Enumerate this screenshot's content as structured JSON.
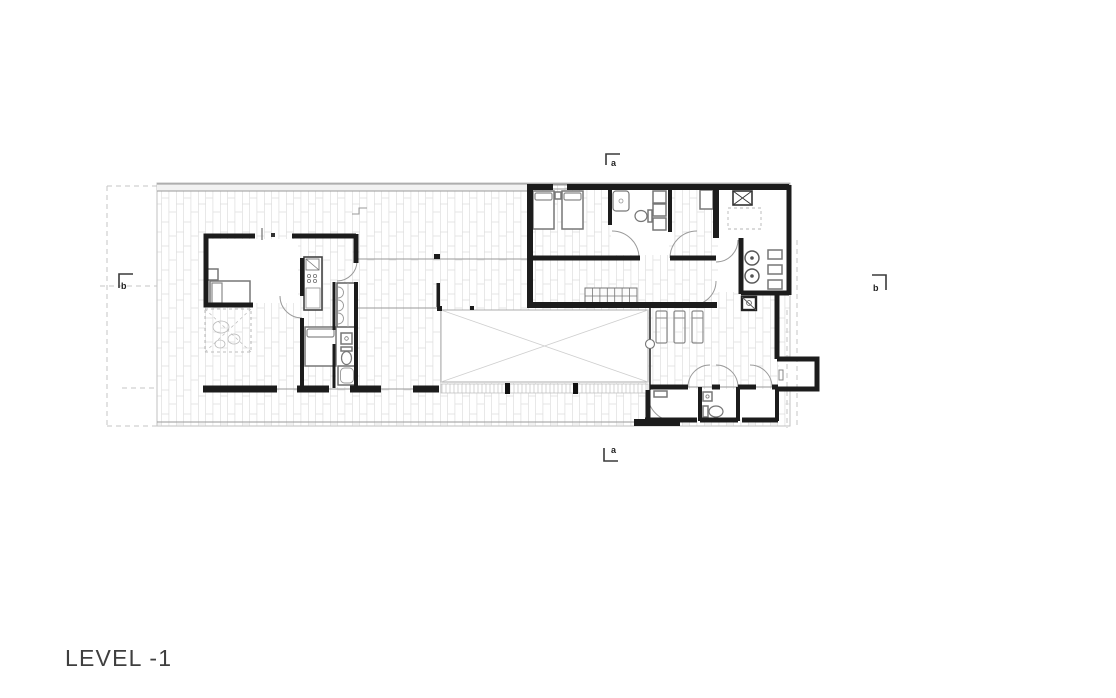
{
  "title": {
    "label": "LEVEL -1"
  },
  "markers": {
    "section_a_top": "a",
    "section_a_bottom": "a",
    "section_b_left": "b",
    "section_b_right": "b"
  },
  "colors": {
    "background": "#ffffff",
    "walls": "#1c1c1c",
    "furniture_outline": "#777777",
    "deck_hatch": "#dedede",
    "thin_line": "#9a9a9a",
    "dashed_line": "#c6c6c6",
    "label_text": "#3f3f3f"
  },
  "plan": {
    "type": "architectural floor plan",
    "features": [
      "vertical plank deck hatching",
      "central pool void with diagonal cross",
      "bedroom wing with two single beds and bathroom",
      "kitchen-laundry room with burners, shelves and skylight box",
      "stair run",
      "three lounge chairs on terrace",
      "service rooms with swing doors",
      "rock garden with dashed cross",
      "section cut markers a-a and b-b",
      "dashed property lines"
    ]
  }
}
